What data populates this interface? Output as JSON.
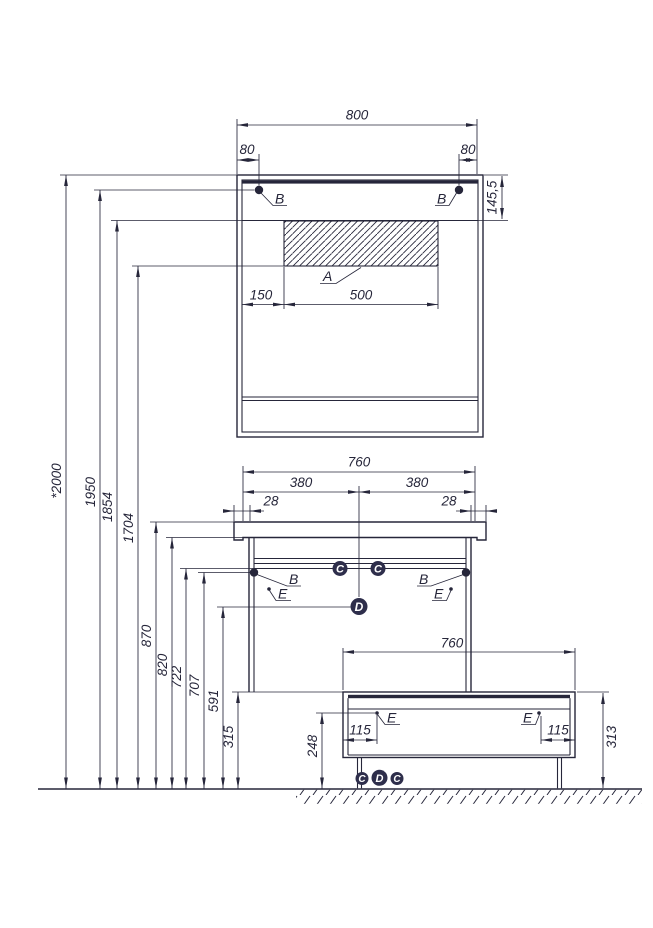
{
  "mirror_cabinet": {
    "width": "800",
    "fastener_offset_left": "80",
    "fastener_offset_right": "80",
    "top_height": "145,5",
    "fastener_label_left": "B",
    "fastener_label_right": "B",
    "zone_label": "A",
    "zone_offset": "150",
    "zone_width": "500"
  },
  "vanity": {
    "width": "760",
    "span_left": "380",
    "span_right": "380",
    "overhang_left": "28",
    "overhang_right": "28",
    "fastener_label_left": "B",
    "fastener_label_right": "B",
    "fitting_c_left": "C",
    "fitting_c_right": "C",
    "fitting_d": "D",
    "hinge_label_left": "E",
    "hinge_label_right": "E"
  },
  "bench": {
    "width": "760",
    "leg_inset_left": "115",
    "leg_inset_right": "115",
    "height": "313",
    "hinge_label_left": "E",
    "hinge_label_right": "E",
    "floor_fitting_left": "C",
    "floor_fitting_center": "D",
    "floor_fitting_right": "C"
  },
  "floor_heights": {
    "overall": "*2000",
    "mirror_fasteners": "1950",
    "zone_top": "1854",
    "zone_bottom": "1704",
    "countertop_top": "870",
    "countertop_bottom": "820",
    "rail": "722",
    "vanity_fasteners": "707",
    "fitting_d": "591",
    "vanity_bottom": "315",
    "bench_rail": "248"
  },
  "colors": {
    "ink": "#26263a",
    "badge": "#2e2e4b"
  }
}
